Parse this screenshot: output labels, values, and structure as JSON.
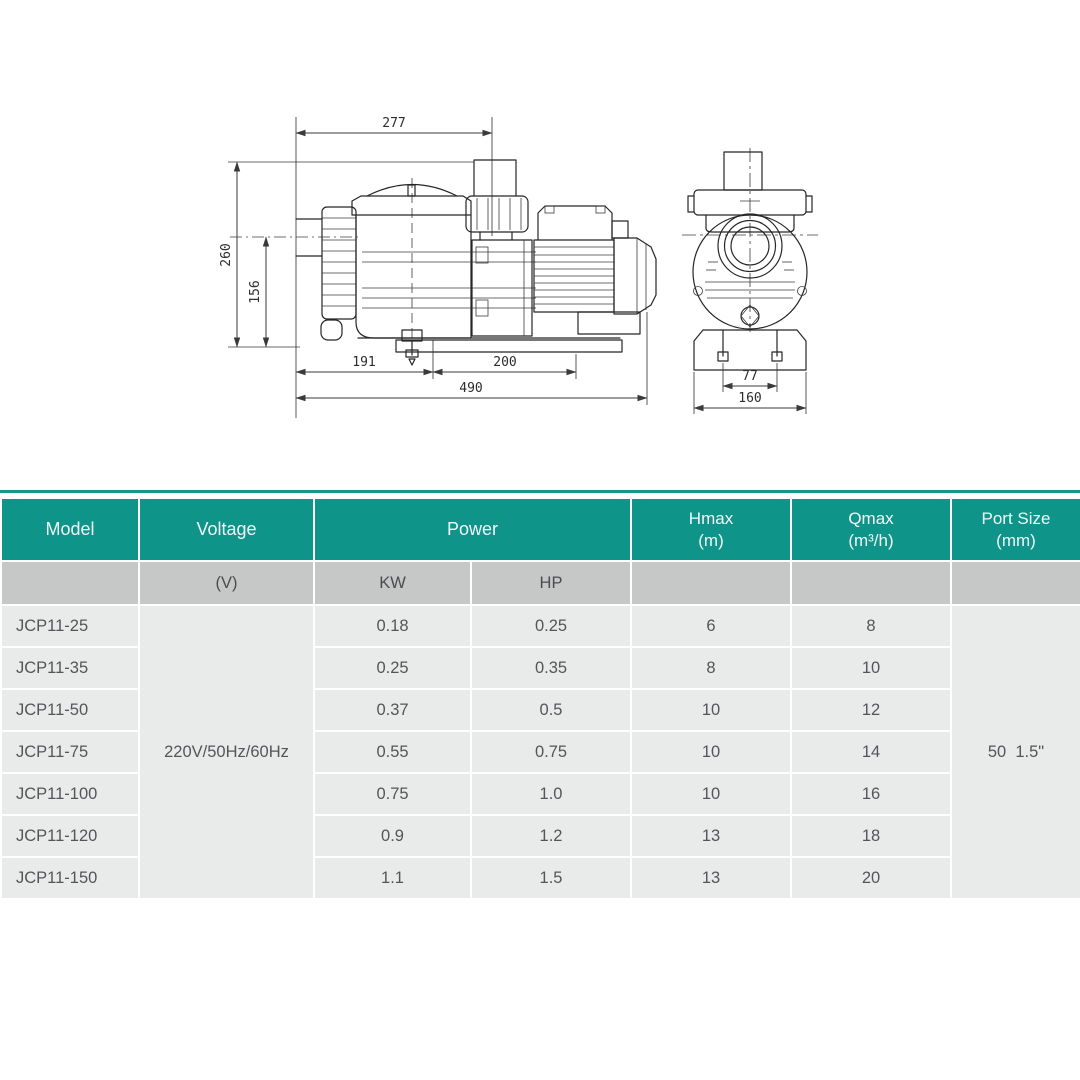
{
  "drawing": {
    "side_view": {
      "dim_top_width": "277",
      "dim_overall_height": "260",
      "dim_center_height": "156",
      "dim_base_front": "191",
      "dim_base_rear": "200",
      "dim_overall_length": "490"
    },
    "front_view": {
      "dim_bolt_spacing": "77",
      "dim_base_width": "160"
    }
  },
  "table": {
    "colors": {
      "header_bg": "#0f948a",
      "header_text": "#eff8f7",
      "subheader_bg": "#c6c7c7",
      "row_bg": "#e9eaea",
      "body_text": "#535658"
    },
    "header": {
      "model": "Model",
      "voltage": "Voltage",
      "power": "Power",
      "hmax_line1": "Hmax",
      "hmax_line2": "(m)",
      "qmax_line1": "Qmax",
      "qmax_line2": "(m³/h)",
      "port_line1": "Port Size",
      "port_line2": "(mm)"
    },
    "subheader": {
      "voltage_unit": "(V)",
      "kw": "KW",
      "hp": "HP"
    },
    "voltage_value": "220V/50Hz/60Hz",
    "port_size_value": "50  1.5\"",
    "rows": [
      {
        "model": "JCP11-25",
        "kw": "0.18",
        "hp": "0.25",
        "hmax": "6",
        "qmax": "8"
      },
      {
        "model": "JCP11-35",
        "kw": "0.25",
        "hp": "0.35",
        "hmax": "8",
        "qmax": "10"
      },
      {
        "model": "JCP11-50",
        "kw": "0.37",
        "hp": "0.5",
        "hmax": "10",
        "qmax": "12"
      },
      {
        "model": "JCP11-75",
        "kw": "0.55",
        "hp": "0.75",
        "hmax": "10",
        "qmax": "14"
      },
      {
        "model": "JCP11-100",
        "kw": "0.75",
        "hp": "1.0",
        "hmax": "10",
        "qmax": "16"
      },
      {
        "model": "JCP11-120",
        "kw": "0.9",
        "hp": "1.2",
        "hmax": "13",
        "qmax": "18"
      },
      {
        "model": "JCP11-150",
        "kw": "1.1",
        "hp": "1.5",
        "hmax": "13",
        "qmax": "20"
      }
    ]
  }
}
